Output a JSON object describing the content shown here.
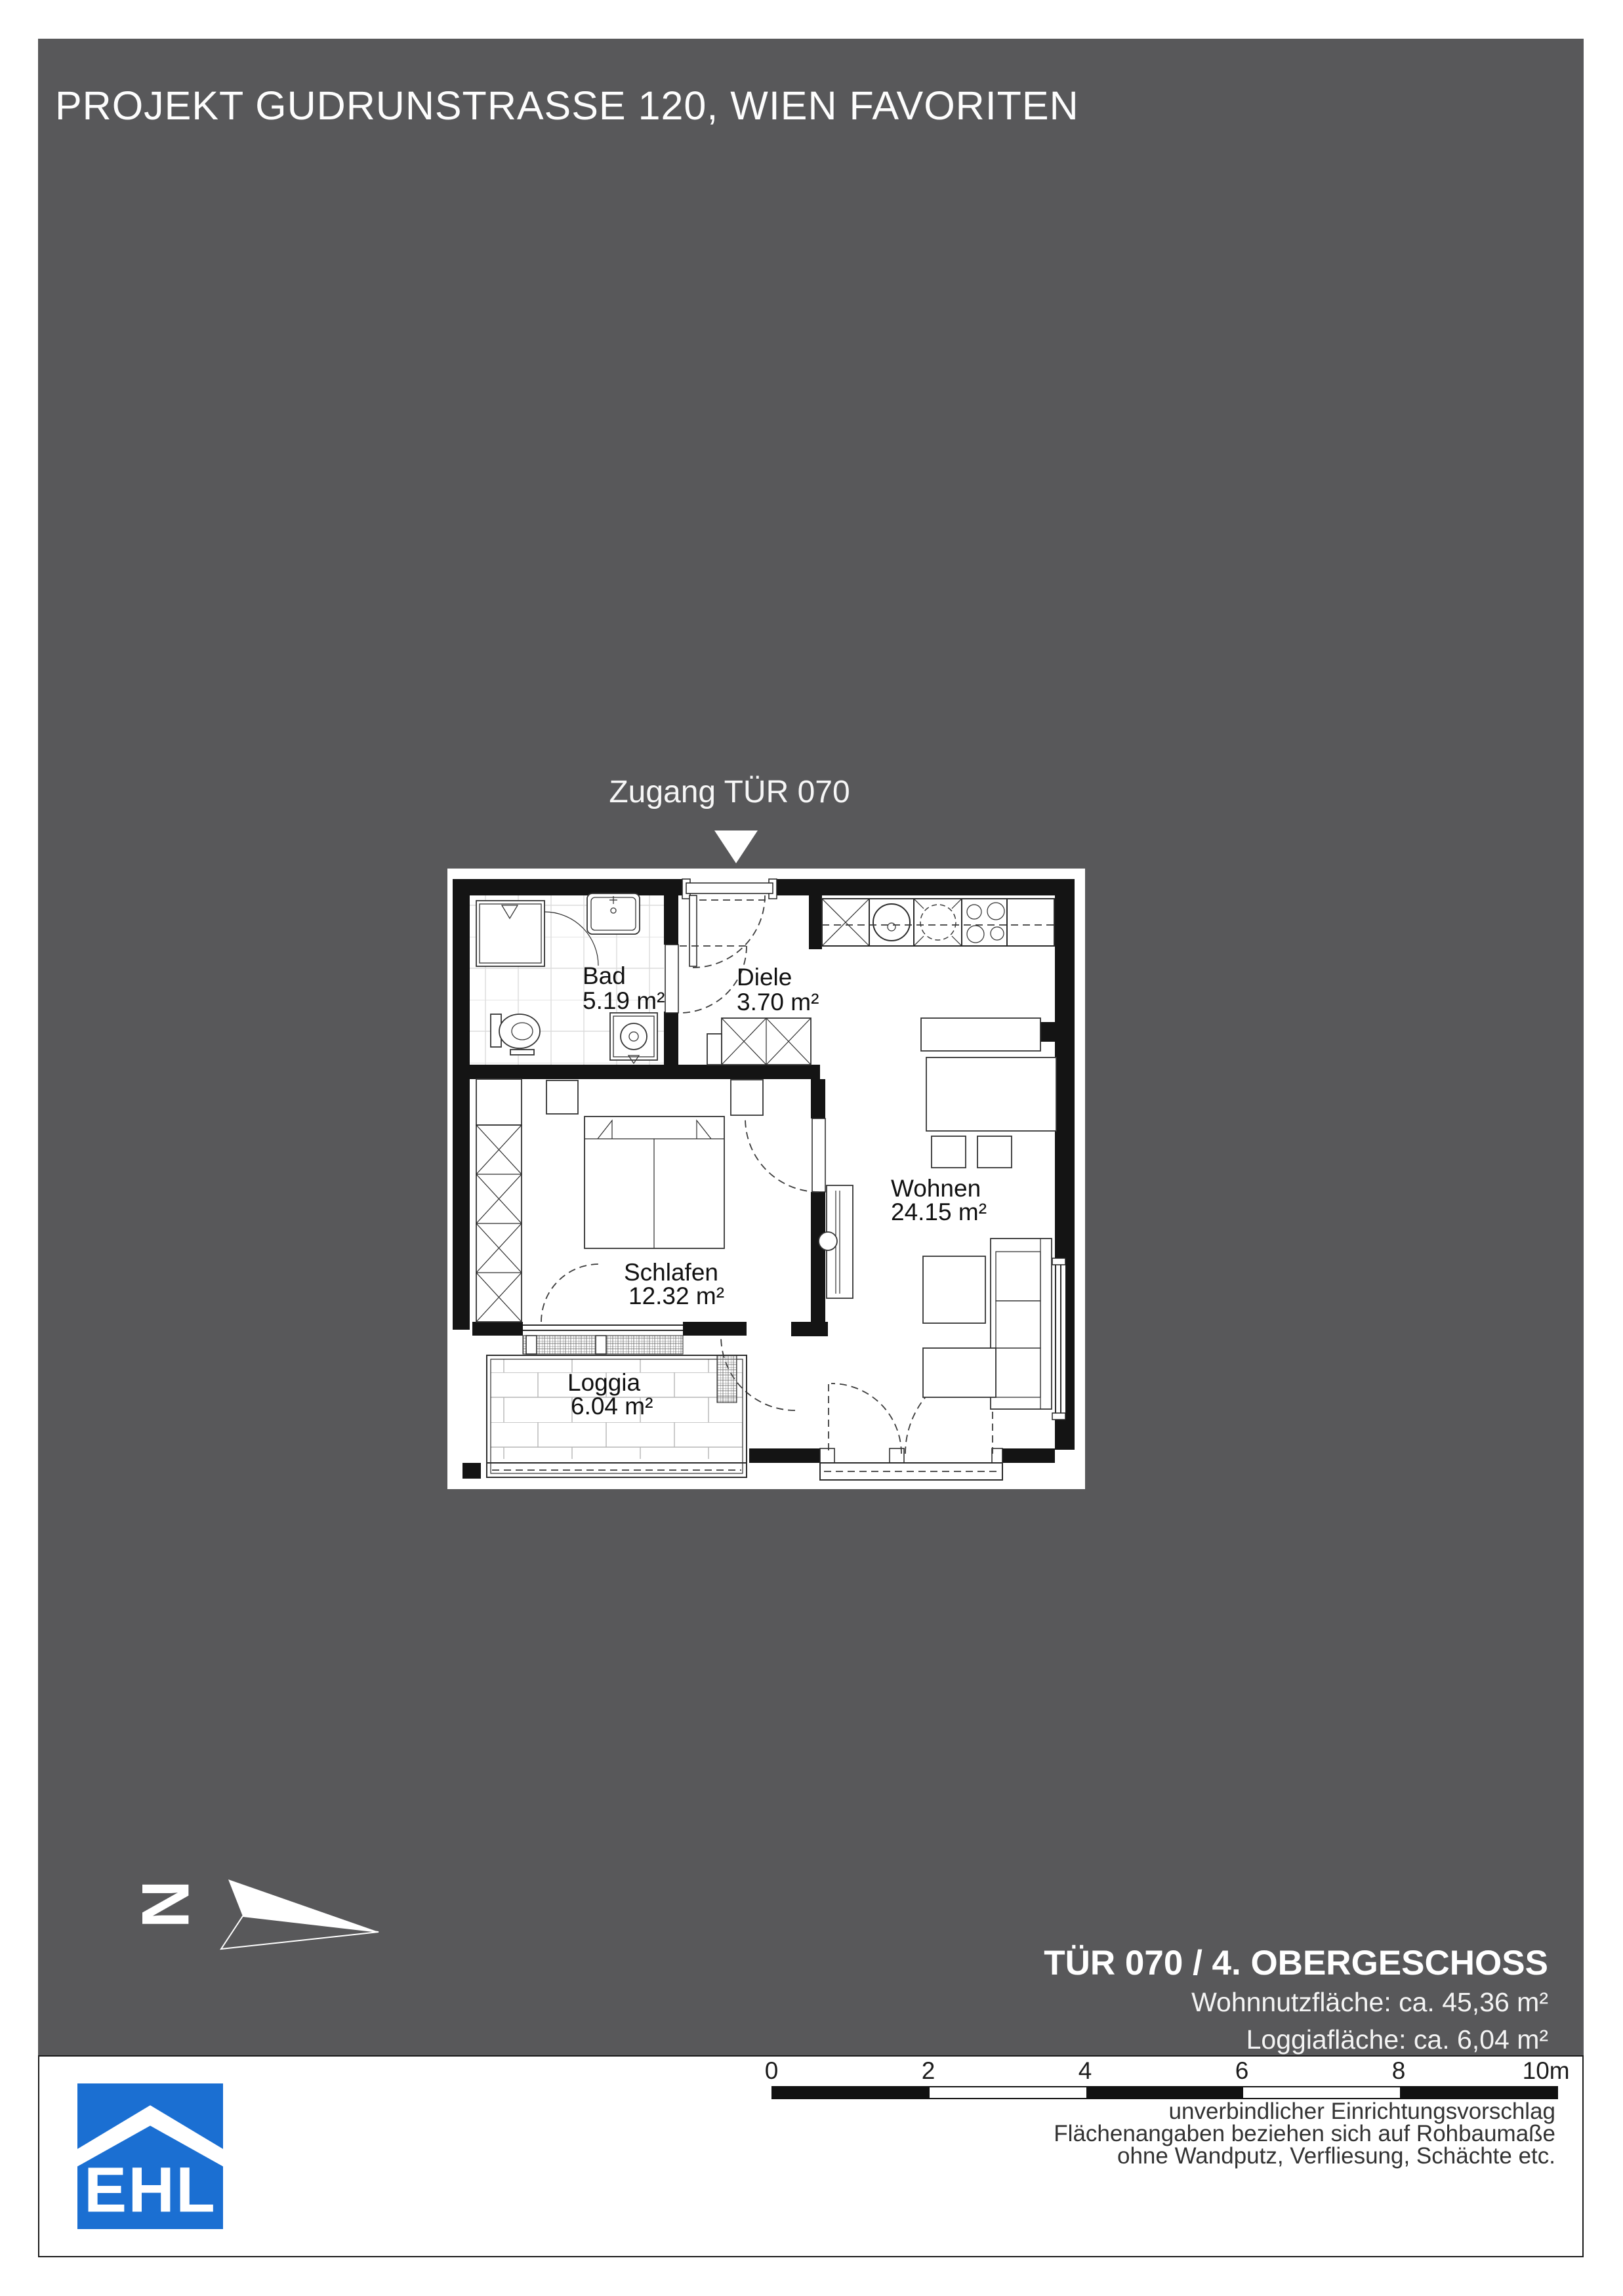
{
  "page": {
    "title": "PROJEKT GUDRUNSTRASSE 120, WIEN FAVORITEN",
    "sheet_color": "#58585A"
  },
  "plan": {
    "access_label": "Zugang TÜR 070",
    "rooms": {
      "bad": {
        "name": "Bad",
        "area": "5.19 m²"
      },
      "diele": {
        "name": "Diele",
        "area": "3.70 m²"
      },
      "wohnen": {
        "name": "Wohnen",
        "area": "24.15 m²"
      },
      "schlafen": {
        "name": "Schlafen",
        "area": "12.32 m²"
      },
      "loggia": {
        "name": "Loggia",
        "area": "6.04 m²"
      }
    }
  },
  "north": {
    "label": "N"
  },
  "unit_info": {
    "title": "TÜR 070 / 4. OBERGESCHOSS",
    "living_area": "Wohnnutzfläche: ca. 45,36 m²",
    "loggia_area": "Loggiafläche: ca. 6,04 m²"
  },
  "scale_bar": {
    "ticks": [
      "0",
      "2",
      "4",
      "6",
      "8",
      "10m"
    ]
  },
  "disclaimer": [
    "unverbindlicher Einrichtungsvorschlag",
    "Flächenangaben beziehen sich auf Rohbaumaße",
    "ohne Wandputz, Verfliesung, Schächte etc."
  ],
  "logo": {
    "text": "EHL",
    "color": "#1B6FD2"
  }
}
